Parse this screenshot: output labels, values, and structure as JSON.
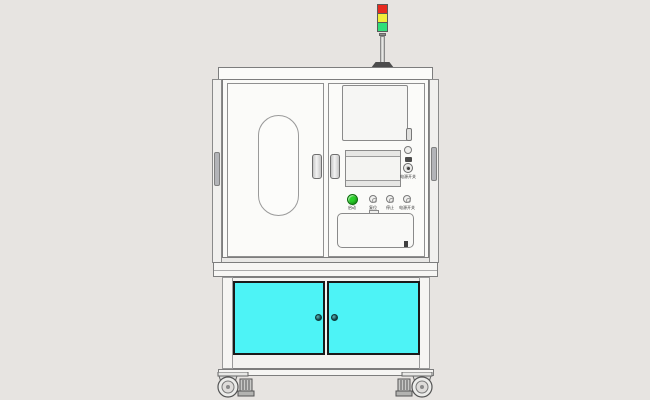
{
  "scene": {
    "background_color": "#e7e4e1"
  },
  "tower_light": {
    "segments": [
      {
        "name": "red-lamp",
        "color": "#e82a1f"
      },
      {
        "name": "yellow-lamp",
        "color": "#f2ee3a"
      },
      {
        "name": "green-lamp",
        "color": "#30df7a"
      }
    ]
  },
  "upper_cabinet": {
    "power_panel_label": "电源开关",
    "buttons": [
      {
        "label": "启动",
        "color": "#28d228"
      },
      {
        "label": "复位",
        "color": "#f1f1ef"
      },
      {
        "label": "停止",
        "color": "#f1f1ef"
      },
      {
        "label": "电源开关",
        "color": "#f1f1ef"
      }
    ]
  },
  "lower_cabinet": {
    "door_color": "#4df3f6"
  }
}
